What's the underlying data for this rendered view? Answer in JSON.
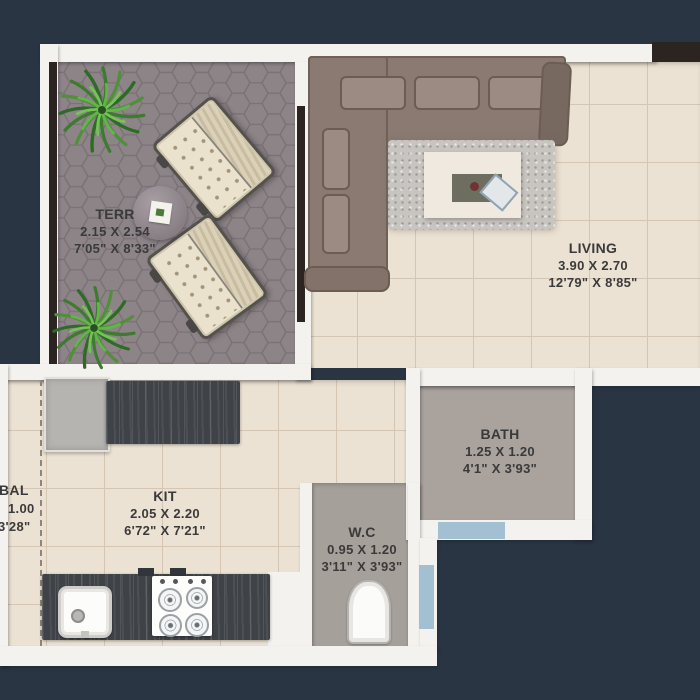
{
  "canvas": {
    "width": 700,
    "height": 700
  },
  "palette": {
    "background": "#2a3543",
    "wall": "#f4f2ee",
    "floor_cream": "#ece2d3",
    "floor_tile_line": "#d4c6b2",
    "terrace_tile": "#8d8488",
    "terrace_tile_line": "#7b7276",
    "bath_floor": "#a9a29d",
    "counter_dark": "#3f4347",
    "sofa_brown": "#8a7a71",
    "chair_cream": "#eae2cd",
    "rug_gray": "#c8c5c1",
    "door_blue": "#a3bfd2",
    "window_dark": "#2b2420",
    "plant_green": "#4f9039",
    "label_text": "#3a3a3a"
  },
  "rooms": {
    "terr": {
      "name": "TERR",
      "dim_m": "2.15 X 2.54",
      "dim_ft": "7'05\" X 8'33\""
    },
    "living": {
      "name": "LIVING",
      "dim_m": "3.90 X 2.70",
      "dim_ft": "12'79\" X 8'85\""
    },
    "bath": {
      "name": "BATH",
      "dim_m": "1.25 X 1.20",
      "dim_ft": "4'1\" X 3'93\""
    },
    "kit": {
      "name": "KIT",
      "dim_m": "2.05 X 2.20",
      "dim_ft": "6'72\" X 7'21\""
    },
    "wc": {
      "name": "W.C",
      "dim_m": "0.95 X 1.20",
      "dim_ft": "3'11\" X 3'93\""
    },
    "bal": {
      "name": "BAL",
      "dim_m": "1.00",
      "dim_ft": "3'28\""
    }
  },
  "furniture": [
    "potted-plant",
    "lounge-chair",
    "round-side-table",
    "l-shaped-sofa",
    "area-rug",
    "coffee-table",
    "laptop",
    "refrigerator",
    "kitchen-counter",
    "kitchen-sink",
    "gas-stove",
    "toilet"
  ]
}
